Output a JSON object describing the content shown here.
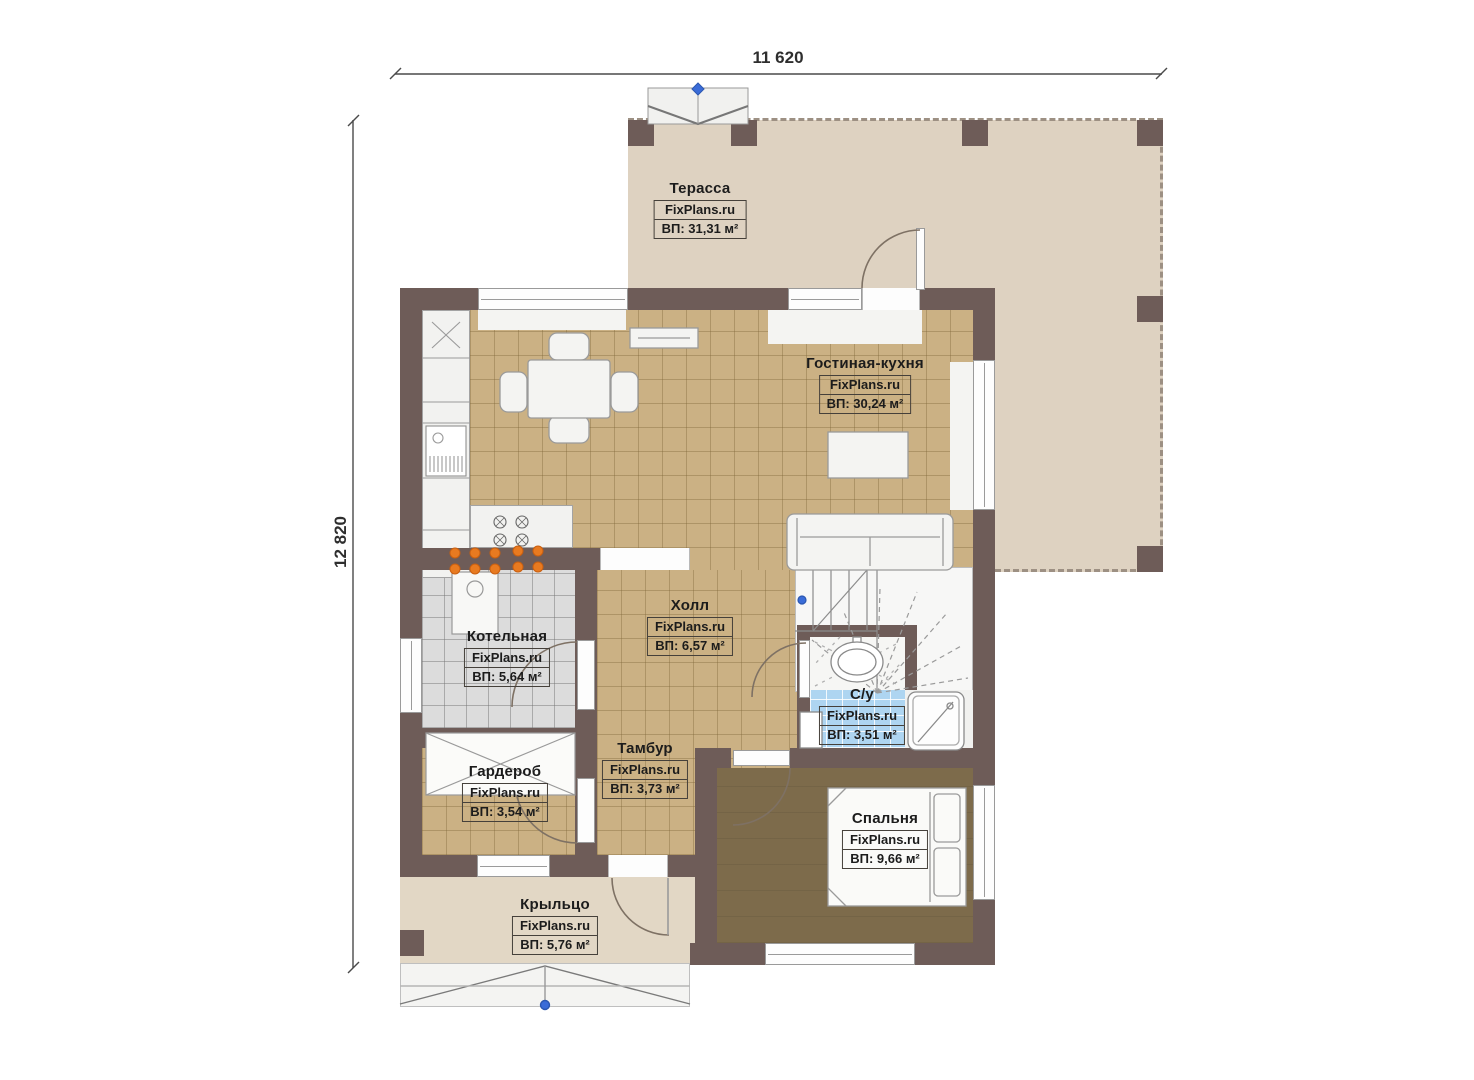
{
  "plan": {
    "brand": "FixPlans.ru",
    "dimensions": {
      "width": "11 620",
      "height": "12 820"
    },
    "rooms": {
      "terrace": {
        "name": "Терасса",
        "brand": "FixPlans.ru",
        "area": "ВП: 31,31 м²"
      },
      "living_kitchen": {
        "name": "Гостиная-кухня",
        "brand": "FixPlans.ru",
        "area": "ВП: 30,24 м²"
      },
      "hall": {
        "name": "Холл",
        "brand": "FixPlans.ru",
        "area": "ВП: 6,57 м²"
      },
      "boiler": {
        "name": "Котельная",
        "brand": "FixPlans.ru",
        "area": "ВП: 5,64 м²"
      },
      "bathroom": {
        "name": "С/у",
        "brand": "FixPlans.ru",
        "area": "ВП: 3,51 м²"
      },
      "vestibule": {
        "name": "Тамбур",
        "brand": "FixPlans.ru",
        "area": "ВП: 3,73 м²"
      },
      "wardrobe": {
        "name": "Гардероб",
        "brand": "FixPlans.ru",
        "area": "ВП: 3,54 м²"
      },
      "bedroom": {
        "name": "Спальня",
        "brand": "FixPlans.ru",
        "area": "ВП: 9,66 м²"
      },
      "porch": {
        "name": "Крыльцо",
        "brand": "FixPlans.ru",
        "area": "ВП: 5,76 м²"
      }
    },
    "colors": {
      "wall": "#6e5c58",
      "terrace_floor": "#ded2c1",
      "tile_floor": "#cbb184",
      "bedroom_floor": "#7d6b4b",
      "bathroom_tile": "#aed5f1",
      "boiler_tile": "#dcdcdc",
      "accent_orange": "#e87a20",
      "marker_blue": "#3a6cd8"
    }
  }
}
